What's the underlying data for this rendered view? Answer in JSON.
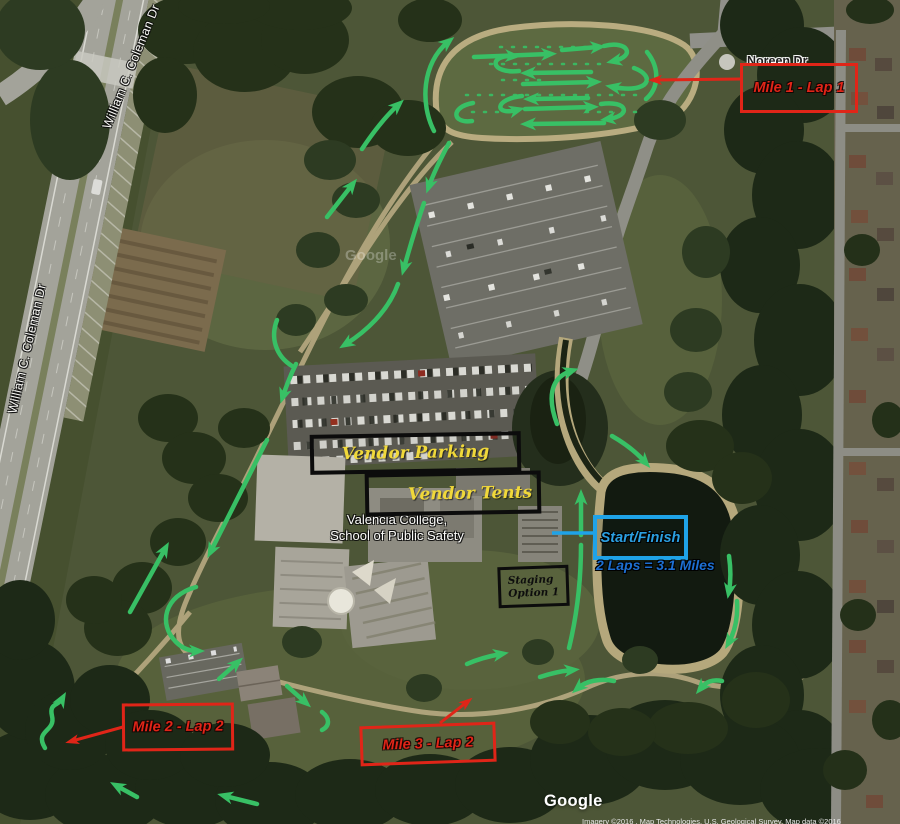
{
  "map": {
    "watermark": "Google",
    "ghost_watermark": "Google",
    "attribution": "Imagery ©2016 , Map Technologies, U.S. Geological Survey, Map data ©2016"
  },
  "roads": {
    "noreen": "Noreen Dr",
    "coleman_top": "William C. Coleman Dr",
    "coleman_left": "William C. Coleman Dr"
  },
  "places": {
    "valencia_line1": "Valencia College,",
    "valencia_line2": "School of Public Safety"
  },
  "course": {
    "mile1": "Mile 1 - Lap 1",
    "mile2": "Mile 2 - Lap 2",
    "mile3": "Mile 3 - Lap 2",
    "start_finish": "Start/Finish",
    "laps_note": "2 Laps = 3.1 Miles",
    "vendor_parking": "Vendor Parking",
    "vendor_tents": "Vendor Tents",
    "staging_line1": "Staging",
    "staging_line2": "Option 1",
    "route_color": "#38c065",
    "marker_red": "#e02518",
    "start_blue": "#1fa3e8",
    "vendor_yellow": "#f0d83a"
  }
}
